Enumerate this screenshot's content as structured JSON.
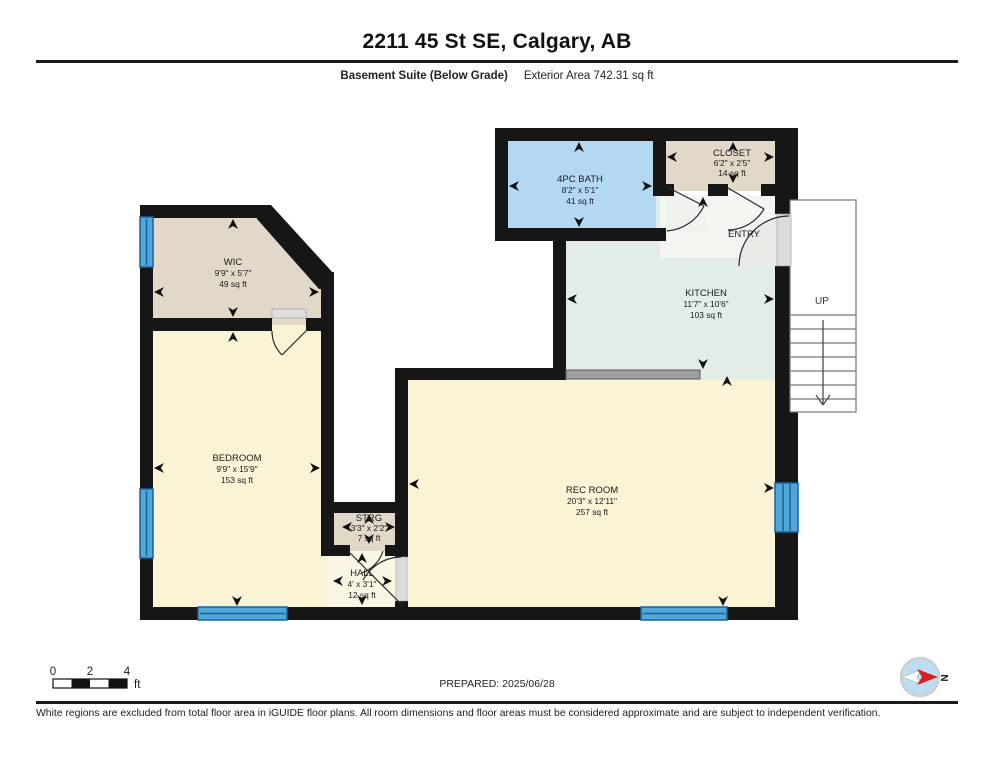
{
  "header": {
    "title": "2211 45 St SE, Calgary, AB",
    "floor_label": "Basement Suite (Below Grade)",
    "area_label": "Exterior Area 742.31 sq ft"
  },
  "plan": {
    "rooms": {
      "wic": {
        "name": "WIC",
        "dims": "9'9\" x 5'7\"",
        "area": "49 sq ft",
        "color": "#E2D8C8"
      },
      "bath": {
        "name": "4PC BATH",
        "dims": "8'2\" x 5'1\"",
        "area": "41 sq ft",
        "color": "#B4D8F2"
      },
      "closet": {
        "name": "CLOSET",
        "dims": "6'2\" x 2'5\"",
        "area": "14 sq ft",
        "color": "#E2D8C8"
      },
      "entry": {
        "name": "ENTRY",
        "color": "#F3F5F1"
      },
      "kitchen": {
        "name": "KITCHEN",
        "dims": "11'7\" x 10'6\"",
        "area": "103 sq ft",
        "color": "#E3EDE7"
      },
      "bedroom": {
        "name": "BEDROOM",
        "dims": "9'9\" x 15'9\"",
        "area": "153 sq ft",
        "color": "#FAF3D5"
      },
      "rec": {
        "name": "REC ROOM",
        "dims": "20'3\" x 12'11\"",
        "area": "257 sq ft",
        "color": "#FAF3D5"
      },
      "strg": {
        "name": "STRG",
        "dims": "3'3\" x 2'2\"",
        "area": "7 sq ft",
        "color": "#E2D8C8"
      },
      "hall": {
        "name": "HALL",
        "dims": "4' x 3'1\"",
        "area": "12 sq ft",
        "color": "#FBF6E3"
      }
    },
    "stairs_label": "UP",
    "wall_color": "#161616",
    "window_color": "#4FA7DA"
  },
  "scale_bar": {
    "tick0": "0",
    "tick2": "2",
    "tick4": "4",
    "unit": "ft"
  },
  "footer": {
    "prepared": "PREPARED: 2025/06/28",
    "compass_label": "N",
    "disclaimer": "White regions are excluded from total floor area in iGUIDE floor plans. All room dimensions and floor areas must be considered approximate and are subject to independent verification."
  }
}
